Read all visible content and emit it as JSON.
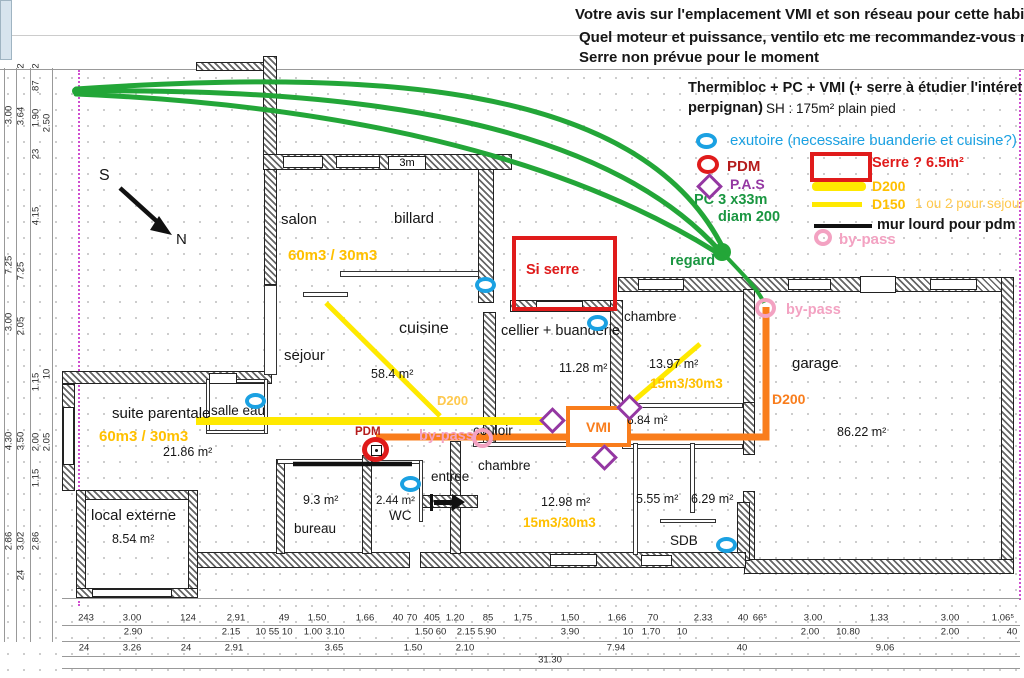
{
  "header": {
    "question_line1": "Votre avis sur l'emplacement VMI et son réseau pour cette habitation ?",
    "question_line2": "Quel moteur et puissance, ventilo etc me recommandez-vous merci",
    "question_line3": "Serre non prévue pour le moment",
    "project_line1": "Thermibloc + PC + VMI (+ serre à étudier l'intéret à",
    "project_line2": "perpignan)",
    "surface": "SH : 175m² plain pied"
  },
  "legend": {
    "exutoire": "exutoire (necessaire buanderie et cuisine?)",
    "pdm": "PDM",
    "pas": "P.A.S",
    "pc_line1": "PC 3 x33m",
    "pc_line2": "diam 200",
    "serre": "Serre ? 6.5m²",
    "d200": "D200",
    "d150": "D150",
    "sejour_question": "1 ou 2 pour sejour ?",
    "mur_lourd": "mur lourd pour pdm",
    "bypass": "by-pass"
  },
  "plan": {
    "compass": {
      "south": "S",
      "north": "N"
    },
    "wall_note": "3m",
    "rooms": {
      "salon": "salon",
      "billard": "billard",
      "cuisine": "cuisine",
      "cuisine_area": "58.4 m²",
      "sejour": "sejour",
      "cellier": "cellier + buanderie",
      "cellier_area": "11.28 m²",
      "chambre_nord": "chambre",
      "chambre_nord_area": "13.97 m²",
      "garage": "garage",
      "garage_area": "86.22 m²",
      "suite": "suite parentale",
      "suite_area": "21.86 m²",
      "salle_eau": "salle eau",
      "local_externe": "local externe",
      "local_externe_area": "8.54 m²",
      "bureau": "bureau",
      "bureau_area": "9.3 m²",
      "wc": "WC",
      "wc_area": "2.44 m²",
      "entree": "entree",
      "couloir": "couloir",
      "chambre_sud": "chambre",
      "chambre_sud_area": "12.98 m²",
      "room_684_area": "6.84 m²",
      "room_555_area": "5.55 m²",
      "room_629_area": "6.29 m²",
      "sdb": "SDB"
    },
    "annotations": {
      "salon_flow": "60m3 / 30m3",
      "suite_flow": "60m3 / 30m3",
      "chambre_nord_flow": "15m3/30m3",
      "chambre_sud_flow": "15m3/30m3",
      "duct_d200": "D200",
      "garage_d200": "D200",
      "regard": "regard",
      "bypass_mid": "by-pass",
      "bypass_garage": "by-pass",
      "pdm": "PDM",
      "vmi": "VMI",
      "si_serre": "Si serre"
    }
  },
  "dimensions": {
    "bottom_rows": [
      {
        "y": 618,
        "items": [
          {
            "t": "243",
            "x": 86
          },
          {
            "t": "3.00",
            "x": 132
          },
          {
            "t": "124",
            "x": 188
          },
          {
            "t": "2.91",
            "x": 236
          },
          {
            "t": "49",
            "x": 284
          },
          {
            "t": "1.50",
            "x": 317
          },
          {
            "t": "1.66",
            "x": 365
          },
          {
            "t": "40",
            "x": 398
          },
          {
            "t": "70",
            "x": 412
          },
          {
            "t": "405",
            "x": 432
          },
          {
            "t": "1.20",
            "x": 455
          },
          {
            "t": "85",
            "x": 488
          },
          {
            "t": "1.75",
            "x": 523
          },
          {
            "t": "1.50",
            "x": 570
          },
          {
            "t": "1.66",
            "x": 617
          },
          {
            "t": "70",
            "x": 653
          },
          {
            "t": "2.33",
            "x": 703
          },
          {
            "t": "40",
            "x": 743
          },
          {
            "t": "66⁵",
            "x": 760
          },
          {
            "t": "3.00",
            "x": 813
          },
          {
            "t": "1.33",
            "x": 879
          },
          {
            "t": "3.00",
            "x": 950
          },
          {
            "t": "1.06⁵",
            "x": 1003
          }
        ]
      },
      {
        "y": 632,
        "items": [
          {
            "t": "2.90",
            "x": 133
          },
          {
            "t": "2.15",
            "x": 231
          },
          {
            "t": "10 55 10",
            "x": 274
          },
          {
            "t": "1.00",
            "x": 313
          },
          {
            "t": "3.10",
            "x": 335
          },
          {
            "t": "1.50",
            "x": 424
          },
          {
            "t": "60",
            "x": 441
          },
          {
            "t": "2.15",
            "x": 466
          },
          {
            "t": "5.90",
            "x": 487
          },
          {
            "t": "3.90",
            "x": 570
          },
          {
            "t": "10",
            "x": 628
          },
          {
            "t": "1.70",
            "x": 651
          },
          {
            "t": "10",
            "x": 682
          },
          {
            "t": "2.00",
            "x": 810
          },
          {
            "t": "10.80",
            "x": 848
          },
          {
            "t": "2.00",
            "x": 950
          },
          {
            "t": "40",
            "x": 1012
          }
        ]
      },
      {
        "y": 648,
        "items": [
          {
            "t": "24",
            "x": 84
          },
          {
            "t": "3.26",
            "x": 132
          },
          {
            "t": "24",
            "x": 186
          },
          {
            "t": "2.91",
            "x": 234
          },
          {
            "t": "3.65",
            "x": 334
          },
          {
            "t": "1.50",
            "x": 413
          },
          {
            "t": "2.10",
            "x": 465
          },
          {
            "t": "7.94",
            "x": 616
          },
          {
            "t": "40",
            "x": 742
          },
          {
            "t": "9.06",
            "x": 885
          }
        ]
      },
      {
        "y": 660,
        "items": [
          {
            "t": "31.30",
            "x": 550
          }
        ]
      }
    ],
    "left_cols": [
      {
        "x": 9,
        "items": [
          {
            "t": "3.00",
            "y": 115
          },
          {
            "t": "7.25",
            "y": 265
          },
          {
            "t": "3.00",
            "y": 322
          },
          {
            "t": "4.30",
            "y": 441
          },
          {
            "t": "2.86",
            "y": 541
          }
        ]
      },
      {
        "x": 21,
        "items": [
          {
            "t": "2",
            "y": 66
          },
          {
            "t": "3.64",
            "y": 116
          },
          {
            "t": "7.25",
            "y": 271
          },
          {
            "t": "2.05",
            "y": 326
          },
          {
            "t": "3.50",
            "y": 441
          },
          {
            "t": "3.02",
            "y": 541
          },
          {
            "t": "24",
            "y": 575
          }
        ]
      },
      {
        "x": 36,
        "items": [
          {
            "t": "2",
            "y": 66
          },
          {
            "t": ".87",
            "y": 87
          },
          {
            "t": "1.90",
            "y": 118
          },
          {
            "t": "23",
            "y": 154
          },
          {
            "t": "4.15",
            "y": 216
          },
          {
            "t": "1.15",
            "y": 382
          },
          {
            "t": "2.00",
            "y": 442
          },
          {
            "t": "1.15",
            "y": 478
          },
          {
            "t": "2.86",
            "y": 541
          }
        ]
      },
      {
        "x": 47,
        "items": [
          {
            "t": "2.50",
            "y": 123
          },
          {
            "t": "10",
            "y": 374
          },
          {
            "t": "2.05",
            "y": 442
          }
        ]
      }
    ]
  },
  "colors": {
    "green": "#23a638",
    "yellow_line": "#ffe900",
    "yellow_text": "#ffc000",
    "orange": "#f97d1c",
    "red": "#e01b1b",
    "dark_red": "#b51c1c",
    "pink": "#f3a2c2",
    "purple": "#9437a2",
    "blue": "#1ba1e2"
  }
}
